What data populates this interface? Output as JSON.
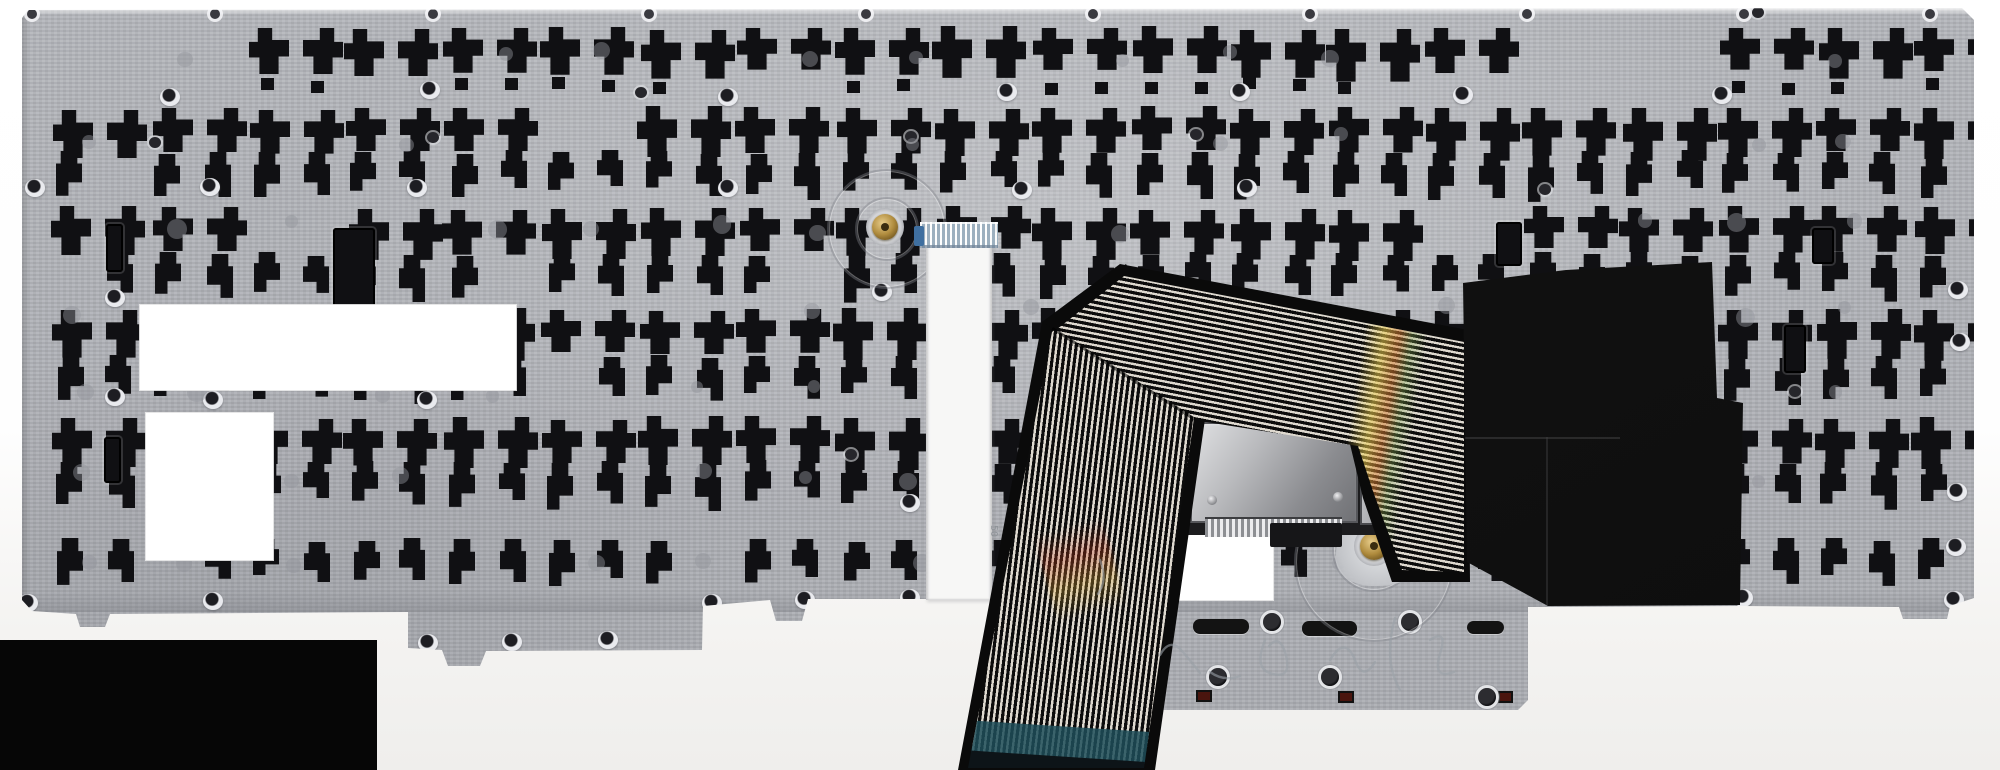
{
  "meta": {
    "description": "Photo of the metal back side of a laptop keyboard assembly with flex ribbon cable, mylar sheet and trackpoint module",
    "canvas": {
      "width": 2000,
      "height": 770
    }
  },
  "colors": {
    "background_top": "#ffffff",
    "background_bottom": "#efeeec",
    "backdrop_black": "#060606",
    "plate_base": "#b5b7bc",
    "plate_dark": "#aaacb2",
    "cutout": "#101013",
    "mylar": "#121212",
    "ribbon_stripe_dark": "#0c0c0c",
    "ribbon_stripe_light": "#ded9cf",
    "teal_tip": "#1f4e59",
    "teal_tip_dark": "#0d1418",
    "brass": "#b08c3e",
    "orange_flex": "#b96f33",
    "module_silver": "#c9cacc",
    "white_label": "#ffffff",
    "ffc_white": "#f7f7f6",
    "ffc_connector": "#9db0bf",
    "ffc_connector_nub": "#3f6fa0",
    "red_marker": "#4a150e",
    "scribble": "#9aa0a6"
  },
  "backdrop": {
    "x": 0,
    "y": 640,
    "w": 377,
    "h": 130
  },
  "plate": {
    "outline": [
      [
        28,
        10
      ],
      [
        1962,
        8
      ],
      [
        1974,
        20
      ],
      [
        1974,
        598
      ],
      [
        1950,
        606
      ],
      [
        1947,
        619
      ],
      [
        1903,
        619
      ],
      [
        1899,
        607
      ],
      [
        1741,
        606
      ],
      [
        1528,
        607
      ],
      [
        1528,
        700
      ],
      [
        1518,
        710
      ],
      [
        1155,
        710
      ],
      [
        1146,
        700
      ],
      [
        1146,
        600
      ],
      [
        962,
        599
      ],
      [
        808,
        599
      ],
      [
        802,
        621
      ],
      [
        776,
        621
      ],
      [
        770,
        600
      ],
      [
        703,
        606
      ],
      [
        702,
        650
      ],
      [
        486,
        651
      ],
      [
        480,
        666
      ],
      [
        448,
        666
      ],
      [
        442,
        650
      ],
      [
        408,
        648
      ],
      [
        408,
        612
      ],
      [
        110,
        614
      ],
      [
        105,
        627
      ],
      [
        80,
        627
      ],
      [
        76,
        614
      ],
      [
        32,
        611
      ],
      [
        22,
        600
      ],
      [
        22,
        18
      ]
    ],
    "top_holes_x": [
      32,
      215,
      433,
      649,
      866,
      1093,
      1310,
      1527,
      1744,
      1930
    ],
    "top_holes_y": 14
  },
  "pattern": {
    "seed": 7,
    "pair_rows": [
      28,
      108,
      208,
      310,
      418
    ],
    "pair_row_h": 46,
    "pair_pitch": 98,
    "pair_x_start": 52,
    "pair_x_end": 1930,
    "single_rows": [
      152,
      254,
      356,
      462,
      540
    ],
    "single_row_h": 40,
    "single_pitch": 49,
    "single_x_start": 58,
    "single_x_end": 1935,
    "square_row_y": 80,
    "skip_chance": 0.07
  },
  "vertical_slots": [
    [
      333,
      228,
      42,
      82
    ],
    [
      106,
      224,
      17,
      48
    ],
    [
      104,
      437,
      17,
      46
    ],
    [
      1496,
      222,
      26,
      44
    ],
    [
      1784,
      325,
      22,
      48
    ],
    [
      1812,
      228,
      22,
      36
    ]
  ],
  "bar_slots": [
    [
      1193,
      619,
      56,
      15
    ],
    [
      1302,
      621,
      55,
      15
    ],
    [
      1467,
      621,
      37,
      13
    ]
  ],
  "red_squares": [
    [
      1196,
      690,
      16,
      12
    ],
    [
      1338,
      691,
      16,
      12
    ],
    [
      1498,
      691,
      15,
      12
    ]
  ],
  "tab_holes": [
    [
      1272,
      622
    ],
    [
      1410,
      622
    ],
    [
      1218,
      677
    ],
    [
      1330,
      677
    ],
    [
      1487,
      697
    ]
  ],
  "rivets_eyelet": [
    [
      170,
      97
    ],
    [
      430,
      90
    ],
    [
      728,
      97
    ],
    [
      1007,
      92
    ],
    [
      1240,
      92
    ],
    [
      1463,
      95
    ],
    [
      1722,
      95
    ],
    [
      35,
      188
    ],
    [
      210,
      187
    ],
    [
      417,
      188
    ],
    [
      728,
      188
    ],
    [
      1022,
      190
    ],
    [
      1247,
      188
    ],
    [
      115,
      298
    ],
    [
      882,
      292
    ],
    [
      115,
      397
    ],
    [
      213,
      400
    ],
    [
      427,
      400
    ],
    [
      910,
      503
    ],
    [
      28,
      603
    ],
    [
      213,
      601
    ],
    [
      428,
      643
    ],
    [
      512,
      642
    ],
    [
      608,
      640
    ],
    [
      712,
      603
    ],
    [
      805,
      600
    ],
    [
      910,
      598
    ],
    [
      1743,
      598
    ],
    [
      1958,
      290
    ],
    [
      1960,
      342
    ],
    [
      1957,
      492
    ],
    [
      1956,
      547
    ],
    [
      1954,
      600
    ]
  ],
  "rivets_dark": [
    [
      155,
      143
    ],
    [
      433,
      138
    ],
    [
      911,
      137
    ],
    [
      1196,
      135
    ],
    [
      1758,
      13
    ],
    [
      641,
      93
    ],
    [
      851,
      455
    ],
    [
      962,
      392
    ],
    [
      1795,
      392
    ],
    [
      1545,
      190
    ]
  ],
  "dots": {
    "rows": [
      48,
      132,
      218,
      302,
      386,
      470,
      552
    ],
    "x_start": 75,
    "pitch": 104,
    "skip": 0.45
  },
  "rings": [
    {
      "cx": 885,
      "cy": 227,
      "r": 58
    },
    {
      "cx": 885,
      "cy": 227,
      "r": 30
    },
    {
      "cx": 1372,
      "cy": 560,
      "r": 78
    },
    {
      "cx": 1372,
      "cy": 548,
      "r": 40
    }
  ],
  "brass_screws": [
    {
      "cx": 885,
      "cy": 227,
      "r": 13
    },
    {
      "cx": 1374,
      "cy": 546,
      "r": 14
    }
  ],
  "white_labels": [
    [
      140,
      305,
      376,
      85
    ],
    [
      146,
      413,
      127,
      147
    ],
    [
      1167,
      527,
      106,
      73
    ]
  ],
  "ffc": {
    "x": 926,
    "y": 222,
    "w": 66,
    "h": 378,
    "connector": {
      "x": 920,
      "y": 222,
      "w": 78,
      "h": 26
    },
    "nub": {
      "x": 914,
      "y": 226,
      "w": 10,
      "h": 20
    },
    "marking": "50",
    "marking_pos": [
      982,
      522
    ]
  },
  "module": {
    "cavity": [
      1175,
      415,
      270,
      120
    ],
    "body": [
      1190,
      422,
      168,
      101
    ],
    "orange": [
      1176,
      425,
      22,
      95
    ],
    "bracket": [
      1360,
      440,
      72,
      85
    ],
    "bracket_slot": [
      1390,
      452,
      22,
      52
    ],
    "comb": [
      1205,
      517,
      137,
      20
    ],
    "black_bar": [
      1270,
      523,
      72,
      24
    ],
    "screws": [
      [
        1212,
        500
      ],
      [
        1338,
        497
      ]
    ],
    "splat": [
      1336,
      518,
      96,
      68
    ]
  },
  "ribbon": {
    "lower_black": [
      [
        958,
        770
      ],
      [
        1042,
        322
      ],
      [
        1126,
        264
      ],
      [
        1206,
        412
      ],
      [
        1155,
        770
      ]
    ],
    "lower_stripes": [
      [
        968,
        768
      ],
      [
        1052,
        332
      ],
      [
        1120,
        278
      ],
      [
        1194,
        418
      ],
      [
        1144,
        768
      ]
    ],
    "upper_black": [
      [
        1042,
        322
      ],
      [
        1120,
        264
      ],
      [
        1468,
        330
      ],
      [
        1470,
        582
      ],
      [
        1392,
        582
      ],
      [
        1363,
        498
      ],
      [
        1348,
        436
      ],
      [
        1194,
        410
      ]
    ],
    "upper_stripes": [
      [
        1056,
        330
      ],
      [
        1124,
        276
      ],
      [
        1464,
        342
      ],
      [
        1464,
        572
      ],
      [
        1402,
        570
      ],
      [
        1374,
        494
      ],
      [
        1358,
        446
      ],
      [
        1200,
        421
      ]
    ],
    "teal_band": [
      [
        964,
        720
      ],
      [
        1150,
        732
      ],
      [
        1146,
        764
      ],
      [
        962,
        752
      ]
    ],
    "black_tip": [
      [
        962,
        750
      ],
      [
        1146,
        762
      ],
      [
        1145,
        772
      ],
      [
        961,
        772
      ]
    ],
    "miter": {
      "x": 1053,
      "y": 327,
      "len": 169,
      "angle": 32.6
    },
    "stripe_pitch_dark": 3.2,
    "stripe_pitch_total": 5.6,
    "lower_angle": "97deg",
    "upper_angle": "11deg"
  },
  "mylar": {
    "outline": [
      [
        1463,
        283
      ],
      [
        1566,
        270
      ],
      [
        1712,
        262
      ],
      [
        1717,
        398
      ],
      [
        1743,
        403
      ],
      [
        1740,
        605
      ],
      [
        1548,
        606
      ],
      [
        1467,
        562
      ]
    ],
    "seam_h": [
      1463,
      437,
      157
    ],
    "seam_v": [
      1546,
      437,
      168
    ]
  },
  "scribbles": [
    "M1160,655 q10,-18 22,-4 t18,22",
    "M1265,640 q-12,30 8,34 q20,5 12,-22 q-6,-18 -16,-6",
    "M1330,660 q15,-25 25,0 q8,22 20,2",
    "M1395,618 q-12,42 5,72",
    "M1430,640 q18,-12 10,14 q-8,26 14,18",
    "M1210,672 q14,10 30,4",
    "M1100,560 q8,20 -2,34"
  ]
}
